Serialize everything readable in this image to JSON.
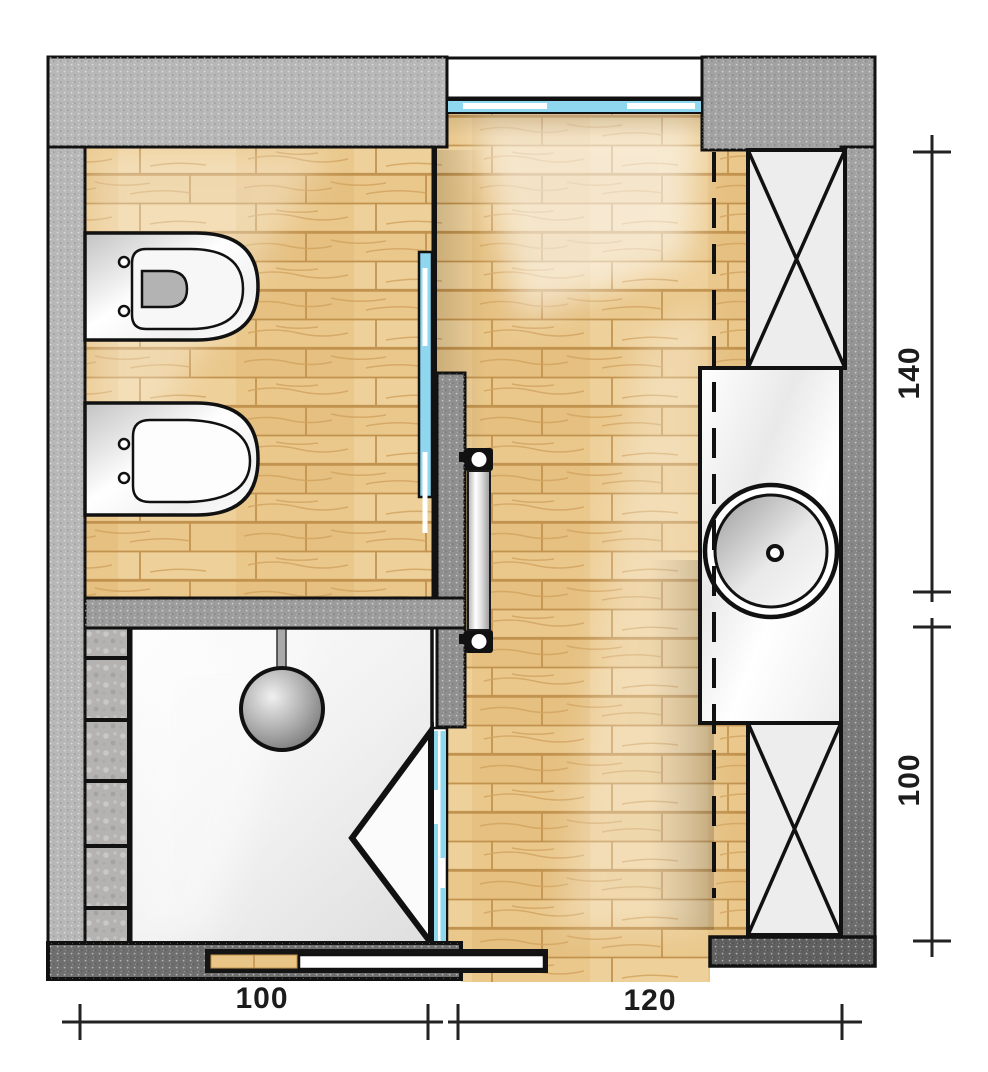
{
  "plan": {
    "dimensions": {
      "right_top": "140",
      "right_bottom": "100",
      "bottom_left": "100",
      "bottom_right": "120"
    },
    "colors": {
      "wood_floor": "#e9c287",
      "wood_joint": "#c2934e",
      "wall_light": "#b7b7b7",
      "wall_medium": "#9e9e9e",
      "wall_dark": "#606060",
      "glass_blue": "#8fd6ef",
      "outline": "#111111",
      "cabinet_fill": "#ededed",
      "tile_gray": "#b4b3b1",
      "shower_floor": "#f4f4f4"
    }
  }
}
